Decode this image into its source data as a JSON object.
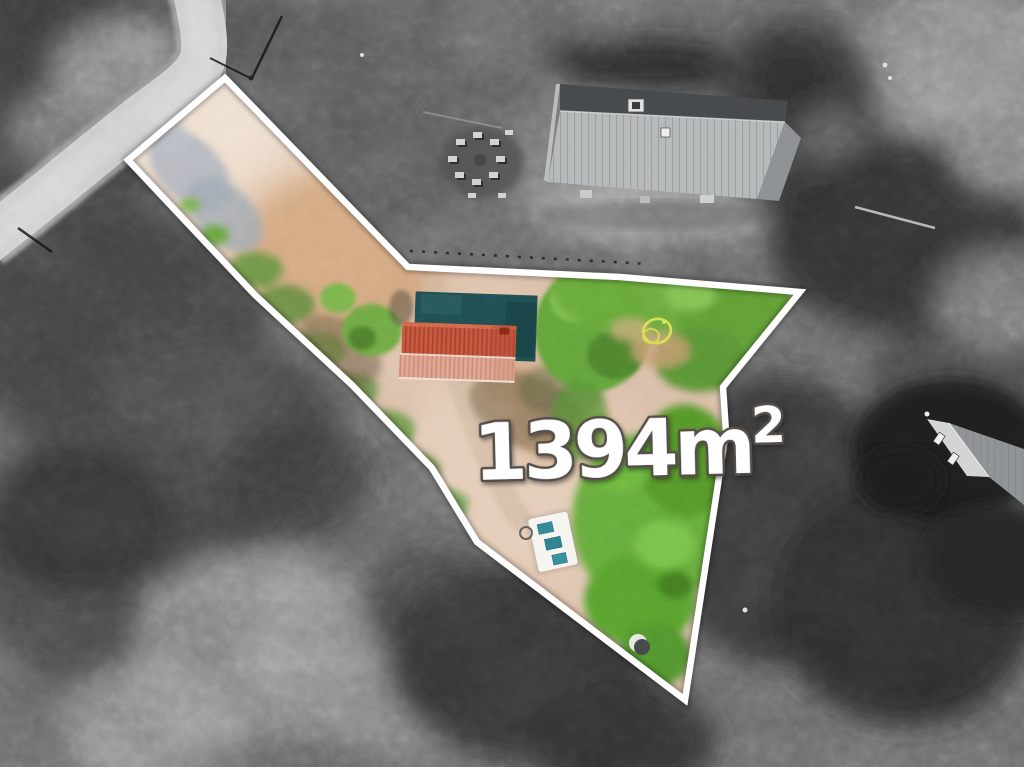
{
  "scene": {
    "kind": "aerial-drone-photo-of-land-plot",
    "plot_highlighted": true,
    "surroundings": "grayscale",
    "plot_interior": "full-color"
  },
  "area_label": {
    "text": "1394m",
    "superscript": "2",
    "full": "1394m²"
  },
  "colors": {
    "boundary_line": "#ffffff",
    "label_fill": "#ffffff",
    "label_outline": "#57504a",
    "plot_dirt": "#d9bda8",
    "plot_grass": "#61a238",
    "barn_roof_red": "#c4533a",
    "barn_roof_pink": "#dfa28c",
    "tarp_teal": "#1d4a4e",
    "beehive_teal": "#2f8596",
    "hose_yellow": "#d9e44d",
    "road": "#c8c8c8",
    "house_roof_light": "#b6b9ba",
    "house_roof_dark": "#45494b"
  }
}
